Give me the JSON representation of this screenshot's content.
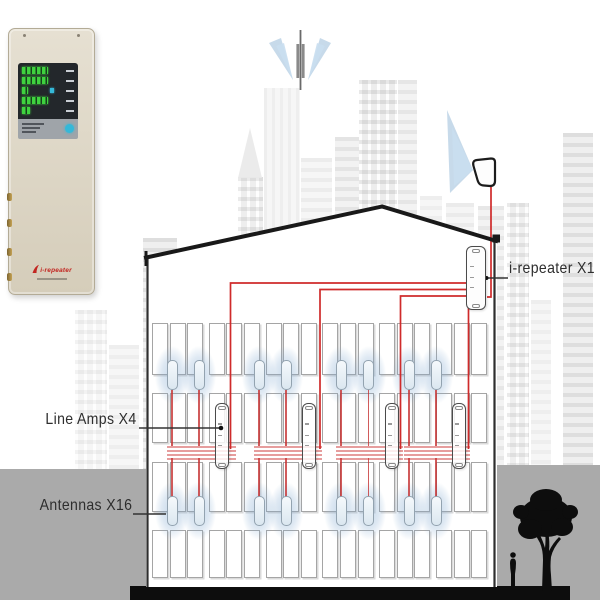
{
  "labels": {
    "repeater": "i-repeater X1",
    "line_amps": "Line Amps X4",
    "antennas": "Antennas X16"
  },
  "system": {
    "repeater_count": 1,
    "line_amp_count": 4,
    "antenna_count": 16,
    "antennas_per_floor": 8,
    "floors_shown": 2
  },
  "device_unit": {
    "logo_text": "i-repeater",
    "led_rows": 5,
    "led_bar_widths": [
      26,
      26,
      6,
      26,
      8
    ],
    "status_dot_row": 3
  },
  "colors": {
    "cable_red": "#cf2b2b",
    "cable_red_light": "rgba(205,60,60,0.5)",
    "beam_blue": "#8fb6d6",
    "beam_blue_light": "#c9def0",
    "ground_gray": "#aaaaaa",
    "silhouette_black": "#0d0d0d",
    "outline_black": "#191919",
    "led_green": "#3fd23f",
    "button_cyan": "#35b8d8"
  }
}
